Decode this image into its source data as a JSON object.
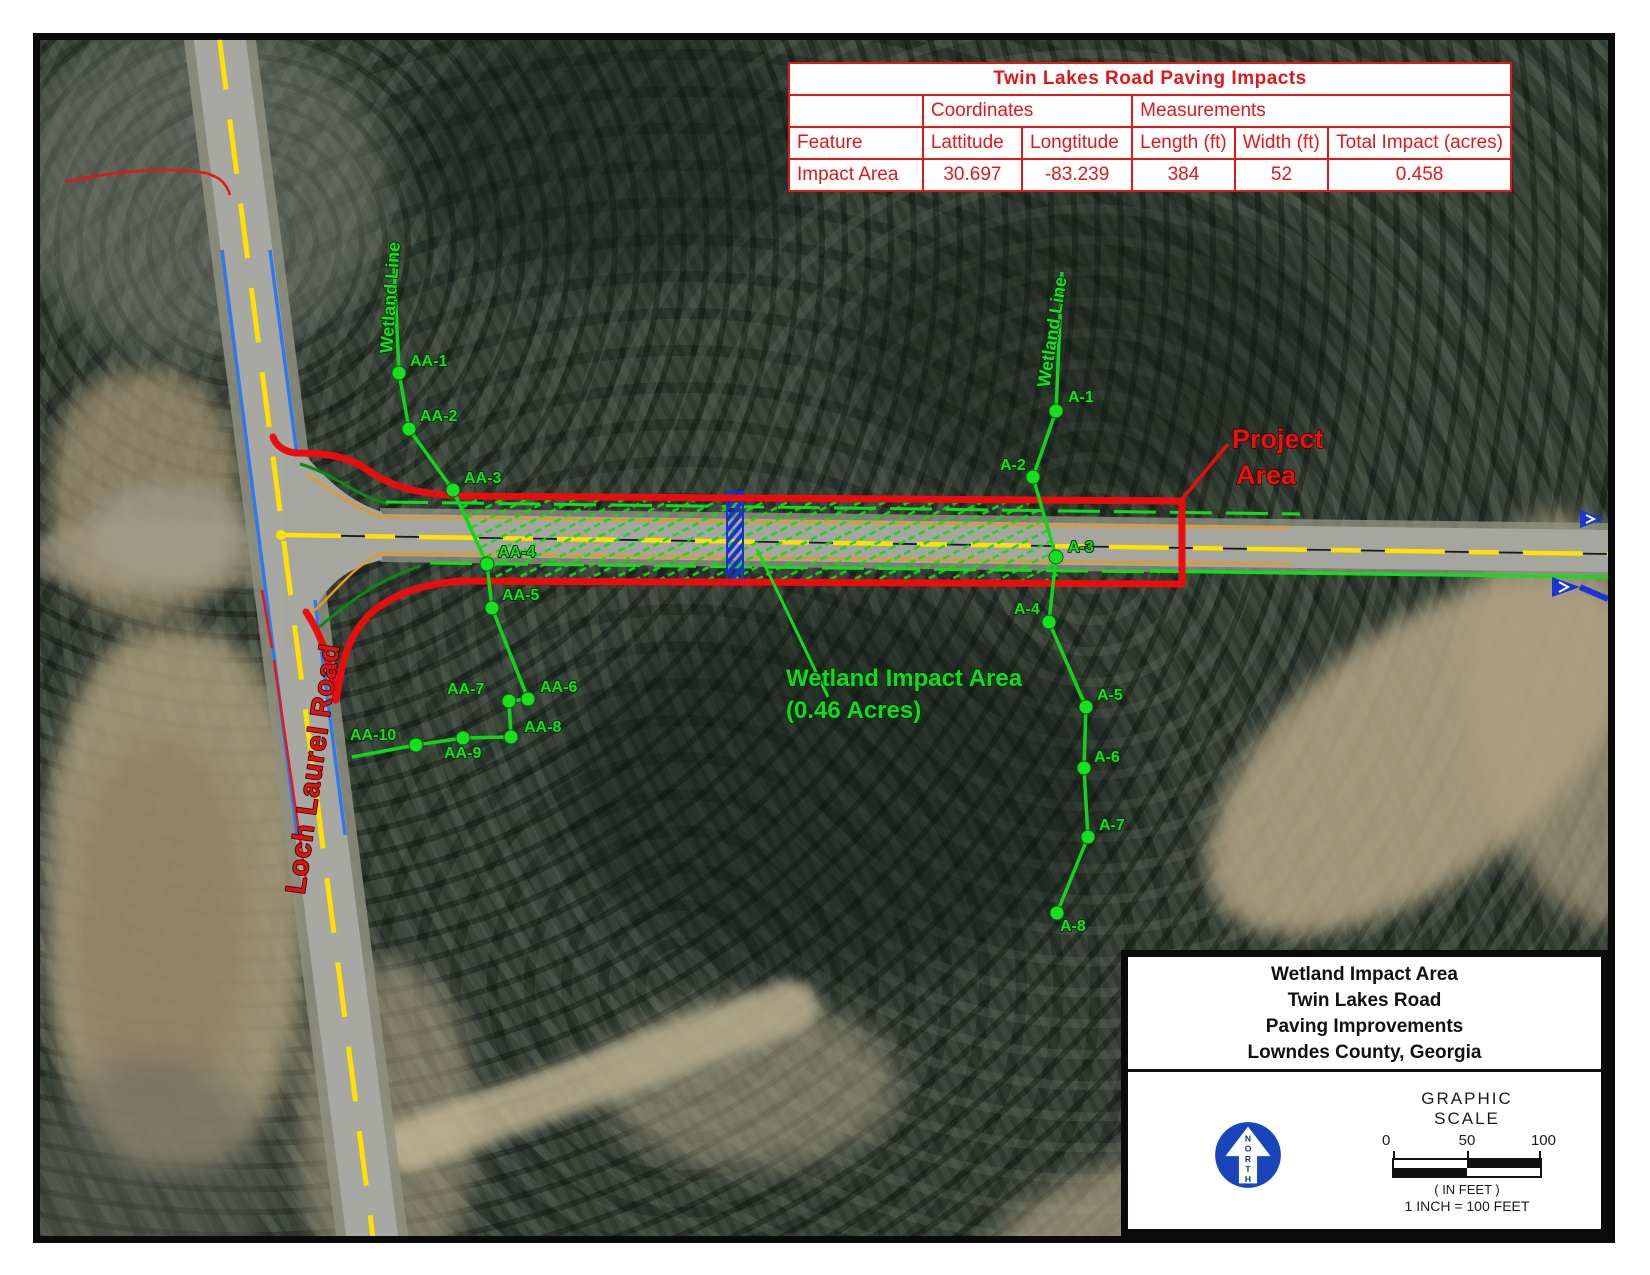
{
  "table": {
    "title": "Twin Lakes Road Paving Impacts",
    "group_coordinates": "Coordinates",
    "group_measurements": "Measurements",
    "columns": [
      "Feature",
      "Lattitude",
      "Longtitude",
      "Length (ft)",
      "Width (ft)",
      "Total Impact (acres)"
    ],
    "rows": [
      [
        "Impact Area",
        "30.697",
        "-83.239",
        "384",
        "52",
        "0.458"
      ]
    ]
  },
  "map": {
    "road_label": "Loch Laurel Road",
    "project_area_line1": "Project",
    "project_area_line2": "Area",
    "impact_label_line1": "Wetland Impact Area",
    "impact_label_line2": "(0.46 Acres)",
    "wetland_line_label_left": "Wetland Line",
    "wetland_line_label_right": "Wetland Line",
    "left_points": [
      "AA-1",
      "AA-2",
      "AA-3",
      "AA-4",
      "AA-5",
      "AA-6",
      "AA-7",
      "AA-8",
      "AA-9",
      "AA-10"
    ],
    "right_points": [
      "A-1",
      "A-2",
      "A-3",
      "A-4",
      "A-5",
      "A-6",
      "A-7",
      "A-8"
    ]
  },
  "title_block": {
    "lines": [
      "Wetland Impact Area",
      "Twin Lakes Road",
      "Paving Improvements",
      "Lowndes County, Georgia"
    ],
    "north_letters": [
      "N",
      "O",
      "R",
      "T",
      "H"
    ],
    "scale": {
      "title": "GRAPHIC SCALE",
      "ticks": [
        "0",
        "50",
        "100"
      ],
      "units": "( IN FEET )",
      "ratio": "1 INCH = 100 FEET"
    }
  },
  "colors": {
    "annotation_red": "#e01818",
    "wetland_green": "#17dd1f",
    "north_blue": "#1845bb",
    "centerline_yellow": "#ffe200",
    "curb_orange": "#e09a28",
    "culvert_blue": "#1836d6"
  }
}
